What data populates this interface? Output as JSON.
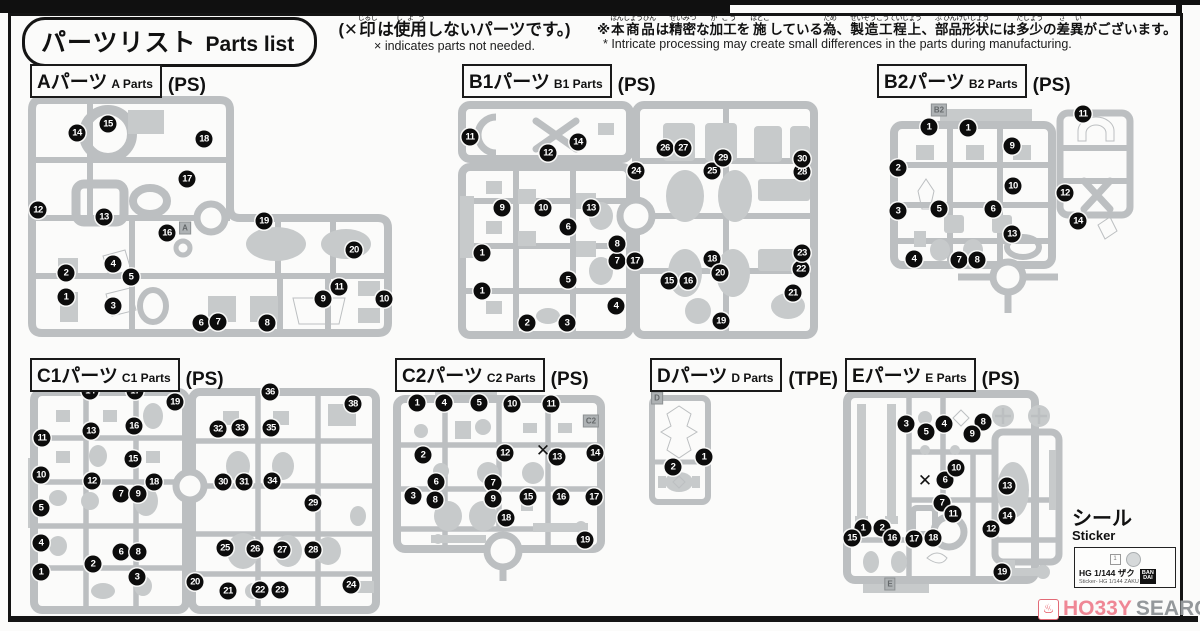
{
  "title": {
    "jp": "パーツリスト",
    "en": "Parts list"
  },
  "notes": {
    "x": {
      "ruby": [
        {
          "b": "(✕",
          "r": ""
        },
        {
          "b": "印",
          "r": "じるし"
        },
        {
          "b": "は",
          "r": ""
        },
        {
          "b": "使用",
          "r": "しよう"
        },
        {
          "b": "しないパーツです。)",
          "r": ""
        }
      ],
      "en": "× indicates parts not needed."
    },
    "mfg": {
      "ruby": [
        {
          "b": "※",
          "r": ""
        },
        {
          "b": "本商品",
          "r": "ほんしょうひん"
        },
        {
          "b": "は",
          "r": ""
        },
        {
          "b": "精密",
          "r": "せいみつ"
        },
        {
          "b": "な",
          "r": ""
        },
        {
          "b": "加工",
          "r": "か こう"
        },
        {
          "b": "を",
          "r": ""
        },
        {
          "b": "施",
          "r": "ほどこ"
        },
        {
          "b": "している",
          "r": ""
        },
        {
          "b": "為",
          "r": "ため"
        },
        {
          "b": "、",
          "r": ""
        },
        {
          "b": "製造工程上",
          "r": "せいぞうこうていじょう"
        },
        {
          "b": "、",
          "r": ""
        },
        {
          "b": "部品形状",
          "r": "ぶ ひんけいじょう"
        },
        {
          "b": "には",
          "r": ""
        },
        {
          "b": "多少",
          "r": "たしょう"
        },
        {
          "b": "の",
          "r": ""
        },
        {
          "b": "差異",
          "r": "さ い"
        },
        {
          "b": "がございます。",
          "r": ""
        }
      ],
      "en": "* Intricate processing may create small differences in the parts during manufacturing."
    }
  },
  "runners": [
    {
      "id": "A",
      "label_jp": "Aパーツ",
      "label_en": "A Parts",
      "material": "(PS)",
      "header": {
        "x": 30,
        "y": 64
      },
      "tag": {
        "text": "A",
        "x": 185,
        "y": 228
      },
      "badges": [
        [
          "1",
          66,
          297
        ],
        [
          "2",
          66,
          273
        ],
        [
          "3",
          113,
          306
        ],
        [
          "4",
          113,
          264
        ],
        [
          "5",
          131,
          277
        ],
        [
          "6",
          201,
          323
        ],
        [
          "7",
          218,
          322
        ],
        [
          "8",
          267,
          323
        ],
        [
          "9",
          323,
          299
        ],
        [
          "10",
          384,
          299
        ],
        [
          "11",
          339,
          287
        ],
        [
          "12",
          38,
          210
        ],
        [
          "13",
          104,
          217
        ],
        [
          "14",
          77,
          133
        ],
        [
          "15",
          108,
          124
        ],
        [
          "16",
          167,
          233
        ],
        [
          "17",
          187,
          179
        ],
        [
          "18",
          204,
          139
        ],
        [
          "19",
          264,
          221
        ],
        [
          "20",
          354,
          250
        ]
      ],
      "marks": []
    },
    {
      "id": "B1",
      "label_jp": "B1パーツ",
      "label_en": "B1 Parts",
      "material": "(PS)",
      "header": {
        "x": 462,
        "y": 64
      },
      "badges": [
        [
          "1",
          482,
          253
        ],
        [
          "1",
          482,
          291
        ],
        [
          "2",
          527,
          323
        ],
        [
          "3",
          567,
          323
        ],
        [
          "4",
          616,
          306
        ],
        [
          "5",
          568,
          280
        ],
        [
          "6",
          568,
          227
        ],
        [
          "7",
          617,
          261
        ],
        [
          "8",
          617,
          244
        ],
        [
          "9",
          502,
          208
        ],
        [
          "10",
          543,
          208
        ],
        [
          "11",
          470,
          137
        ],
        [
          "12",
          548,
          153
        ],
        [
          "13",
          591,
          208
        ],
        [
          "14",
          578,
          142
        ],
        [
          "15",
          669,
          281
        ],
        [
          "16",
          688,
          281
        ],
        [
          "17",
          635,
          261
        ],
        [
          "18",
          712,
          259
        ],
        [
          "19",
          721,
          321
        ],
        [
          "20",
          720,
          273
        ],
        [
          "21",
          793,
          293
        ],
        [
          "22",
          801,
          269
        ],
        [
          "23",
          802,
          253
        ],
        [
          "24",
          636,
          171
        ],
        [
          "25",
          712,
          171
        ],
        [
          "26",
          665,
          148
        ],
        [
          "27",
          683,
          148
        ],
        [
          "28",
          802,
          172
        ],
        [
          "29",
          723,
          158
        ],
        [
          "30",
          802,
          159
        ]
      ],
      "marks": []
    },
    {
      "id": "B2",
      "label_jp": "B2パーツ",
      "label_en": "B2 Parts",
      "material": "(PS)",
      "header": {
        "x": 877,
        "y": 64
      },
      "tag": {
        "text": "B2",
        "x": 939,
        "y": 110
      },
      "badges": [
        [
          "1",
          929,
          127
        ],
        [
          "1",
          968,
          128
        ],
        [
          "2",
          898,
          168
        ],
        [
          "3",
          898,
          211
        ],
        [
          "4",
          914,
          259
        ],
        [
          "5",
          939,
          209
        ],
        [
          "6",
          993,
          209
        ],
        [
          "7",
          959,
          260
        ],
        [
          "8",
          977,
          260
        ],
        [
          "9",
          1012,
          146
        ],
        [
          "10",
          1013,
          186
        ],
        [
          "11",
          1083,
          114
        ],
        [
          "12",
          1065,
          193
        ],
        [
          "13",
          1012,
          234
        ],
        [
          "14",
          1078,
          221
        ]
      ],
      "marks": []
    },
    {
      "id": "C1",
      "label_jp": "C1パーツ",
      "label_en": "C1 Parts",
      "material": "(PS)",
      "header": {
        "x": 30,
        "y": 358
      },
      "badges": [
        [
          "1",
          41,
          572
        ],
        [
          "2",
          93,
          564
        ],
        [
          "3",
          137,
          577
        ],
        [
          "4",
          41,
          543
        ],
        [
          "5",
          41,
          508
        ],
        [
          "6",
          121,
          552
        ],
        [
          "7",
          121,
          494
        ],
        [
          "8",
          138,
          552
        ],
        [
          "9",
          138,
          494
        ],
        [
          "10",
          41,
          475
        ],
        [
          "11",
          42,
          438
        ],
        [
          "12",
          92,
          481
        ],
        [
          "13",
          91,
          431
        ],
        [
          "14",
          90,
          391
        ],
        [
          "15",
          133,
          459
        ],
        [
          "16",
          134,
          426
        ],
        [
          "17",
          135,
          391
        ],
        [
          "18",
          154,
          482
        ],
        [
          "19",
          175,
          402
        ],
        [
          "20",
          195,
          582
        ],
        [
          "21",
          228,
          591
        ],
        [
          "22",
          260,
          590
        ],
        [
          "23",
          280,
          590
        ],
        [
          "24",
          351,
          585
        ],
        [
          "25",
          225,
          548
        ],
        [
          "26",
          255,
          549
        ],
        [
          "27",
          282,
          550
        ],
        [
          "28",
          313,
          550
        ],
        [
          "29",
          313,
          503
        ],
        [
          "30",
          223,
          482
        ],
        [
          "31",
          244,
          482
        ],
        [
          "32",
          218,
          429
        ],
        [
          "33",
          240,
          428
        ],
        [
          "34",
          272,
          481
        ],
        [
          "35",
          271,
          428
        ],
        [
          "36",
          270,
          392
        ],
        [
          "38",
          353,
          404
        ]
      ],
      "marks": []
    },
    {
      "id": "C2",
      "label_jp": "C2パーツ",
      "label_en": "C2 Parts",
      "material": "(PS)",
      "header": {
        "x": 395,
        "y": 358
      },
      "tag": {
        "text": "C2",
        "x": 591,
        "y": 421
      },
      "badges": [
        [
          "1",
          417,
          403
        ],
        [
          "2",
          423,
          455
        ],
        [
          "3",
          413,
          496
        ],
        [
          "4",
          444,
          403
        ],
        [
          "5",
          479,
          403
        ],
        [
          "6",
          436,
          482
        ],
        [
          "7",
          493,
          483
        ],
        [
          "8",
          435,
          500
        ],
        [
          "9",
          493,
          499
        ],
        [
          "10",
          512,
          404
        ],
        [
          "11",
          551,
          404
        ],
        [
          "12",
          505,
          453
        ],
        [
          "13",
          557,
          457
        ],
        [
          "14",
          595,
          453
        ],
        [
          "15",
          528,
          497
        ],
        [
          "16",
          561,
          497
        ],
        [
          "17",
          594,
          497
        ],
        [
          "18",
          506,
          518
        ],
        [
          "19",
          585,
          540
        ]
      ],
      "marks": [
        [
          543,
          451
        ]
      ]
    },
    {
      "id": "D",
      "label_jp": "Dパーツ",
      "label_en": "D Parts",
      "material": "(TPE)",
      "header": {
        "x": 650,
        "y": 358
      },
      "tag": {
        "text": "D",
        "x": 657,
        "y": 398
      },
      "badges": [
        [
          "1",
          704,
          457
        ],
        [
          "2",
          673,
          467
        ]
      ],
      "marks": []
    },
    {
      "id": "E",
      "label_jp": "Eパーツ",
      "label_en": "E Parts",
      "material": "(PS)",
      "header": {
        "x": 845,
        "y": 358
      },
      "tag": {
        "text": "E",
        "x": 890,
        "y": 584
      },
      "badges": [
        [
          "1",
          863,
          528
        ],
        [
          "2",
          882,
          528
        ],
        [
          "3",
          906,
          424
        ],
        [
          "4",
          944,
          424
        ],
        [
          "5",
          926,
          432
        ],
        [
          "6",
          945,
          480
        ],
        [
          "7",
          942,
          503
        ],
        [
          "8",
          983,
          422
        ],
        [
          "9",
          972,
          434
        ],
        [
          "10",
          956,
          468
        ],
        [
          "11",
          953,
          514
        ],
        [
          "12",
          991,
          529
        ],
        [
          "13",
          1007,
          486
        ],
        [
          "14",
          1007,
          516
        ],
        [
          "15",
          852,
          538
        ],
        [
          "16",
          892,
          538
        ],
        [
          "17",
          914,
          539
        ],
        [
          "18",
          933,
          538
        ],
        [
          "19",
          1002,
          572
        ]
      ],
      "marks": [
        [
          925,
          481
        ]
      ]
    }
  ],
  "sticker": {
    "label_jp": "シール",
    "label_en": "Sticker",
    "chip_no": "1",
    "line1": "HG 1/144 ザク",
    "line2": "Sticker- HG 1/144 ZAKU",
    "brand_top": "BAN",
    "brand_bottom": "DAI"
  },
  "watermark": {
    "hobby": "HO33Y",
    "search": "SEARCH"
  }
}
